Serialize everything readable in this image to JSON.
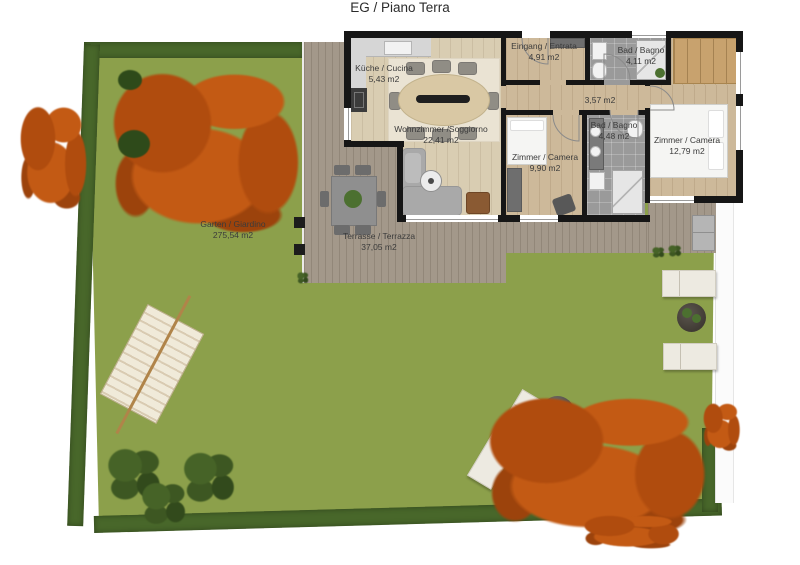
{
  "title": "EG / Piano Terra",
  "rooms": {
    "kitchen": {
      "label": "Küche / Cucina",
      "area": "5,43 m2"
    },
    "living": {
      "label": "Wohnzimmer /Soggiorno",
      "area": "22,41 m2"
    },
    "entrance": {
      "label": "Eingang / Entrata",
      "area": "4,91 m2"
    },
    "bath_top": {
      "label": "Bad / Bagno",
      "area": "4,11 m2"
    },
    "hallway": {
      "area": "3,57 m2"
    },
    "bath_mid": {
      "label": "Bad / Bagno",
      "area": "4,48 m2"
    },
    "bedroom_small": {
      "label": "Zimmer / Camera",
      "area": "9,90 m2"
    },
    "bedroom_large": {
      "label": "Zimmer / Camera",
      "area": "12,79 m2"
    },
    "garden": {
      "label": "Garten / Giardino",
      "area": "275,54 m2"
    },
    "terrace": {
      "label": "Terrasse / Terrazza",
      "area": "37,05 m2"
    }
  },
  "colors": {
    "wall": "#161616",
    "grass": "#8ca04b",
    "hedge": "#48672a",
    "deck": "#a3988a",
    "wood_light": "#d9cdb2",
    "wood_mid": "#cdb99a",
    "tile": "#9a9a9a",
    "rug": "#eae3d3",
    "table_wood": "#d9c8a4",
    "wardrobe": "#c8a26e",
    "orange": "#c35a14",
    "orange2": "#b04c0e",
    "orange3": "#9c430c",
    "label": "#3b3b3b"
  }
}
